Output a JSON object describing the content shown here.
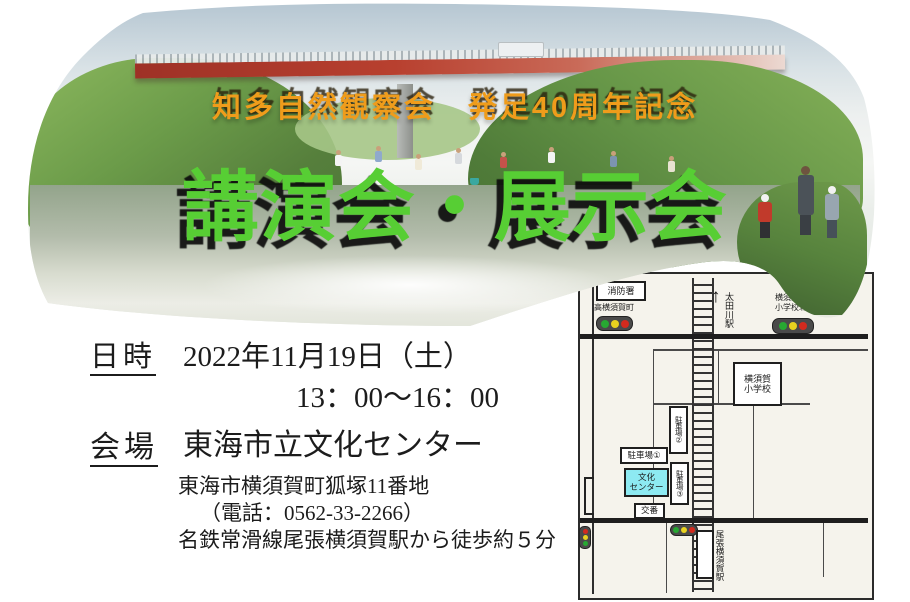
{
  "banner": {
    "subtitle": "知多自然観察会　発足40周年記念",
    "subtitle_color": "#ef9c1b",
    "title": "講演会・展示会",
    "title_color": "#57ce34"
  },
  "details": {
    "datetime_label": "日時",
    "datetime_value": "2022年11月19日（土）",
    "time_value": "13：00～16：00",
    "venue_label": "会場",
    "venue_name": "東海市立文化センター",
    "address": "東海市横須賀町狐塚11番地",
    "phone": "（電話：0562-33-2266）",
    "access": "名鉄常滑線尾張横須賀駅から徒歩約５分"
  },
  "map": {
    "fire_station": "消防署",
    "intersection_west": "高横須賀町",
    "north_arrow": "↑",
    "station_north": "太田川駅",
    "intersection_east_line1": "横須賀",
    "intersection_east_line2": "小学校北",
    "school_line1": "横須賀",
    "school_line2": "小学校",
    "parking_1": "駐車場①",
    "parking_2": "駐車場②",
    "parking_3": "駐車場③",
    "culture_center_line1": "文化",
    "culture_center_line2": "センター",
    "police_box": "交番",
    "station_south": "尾張横須賀駅",
    "culture_center_bg": "#8deaf2",
    "signal_green": "#27a832",
    "signal_yellow": "#e8d21f",
    "signal_red": "#d32a1e"
  }
}
